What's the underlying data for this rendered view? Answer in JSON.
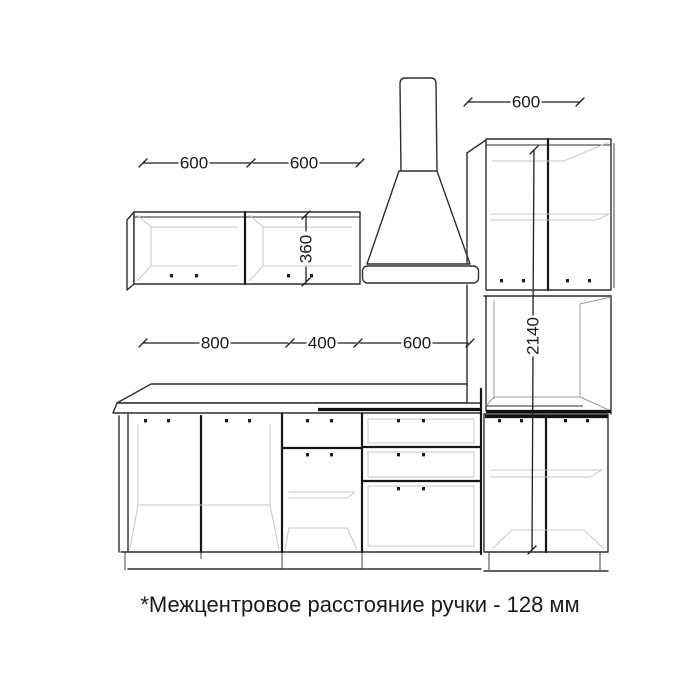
{
  "drawing": {
    "footnote": "*Межцентровое расстояние ручки - 128 мм",
    "dimensions": {
      "wall_cabinet_left": "600",
      "wall_cabinet_right": "600",
      "tall_cabinet_width": "600",
      "wall_cabinet_height": "360",
      "base_cabinet_wide": "800",
      "base_cabinet_narrow": "400",
      "base_cabinet_drawers": "600",
      "tall_cabinet_height": "2140"
    }
  }
}
